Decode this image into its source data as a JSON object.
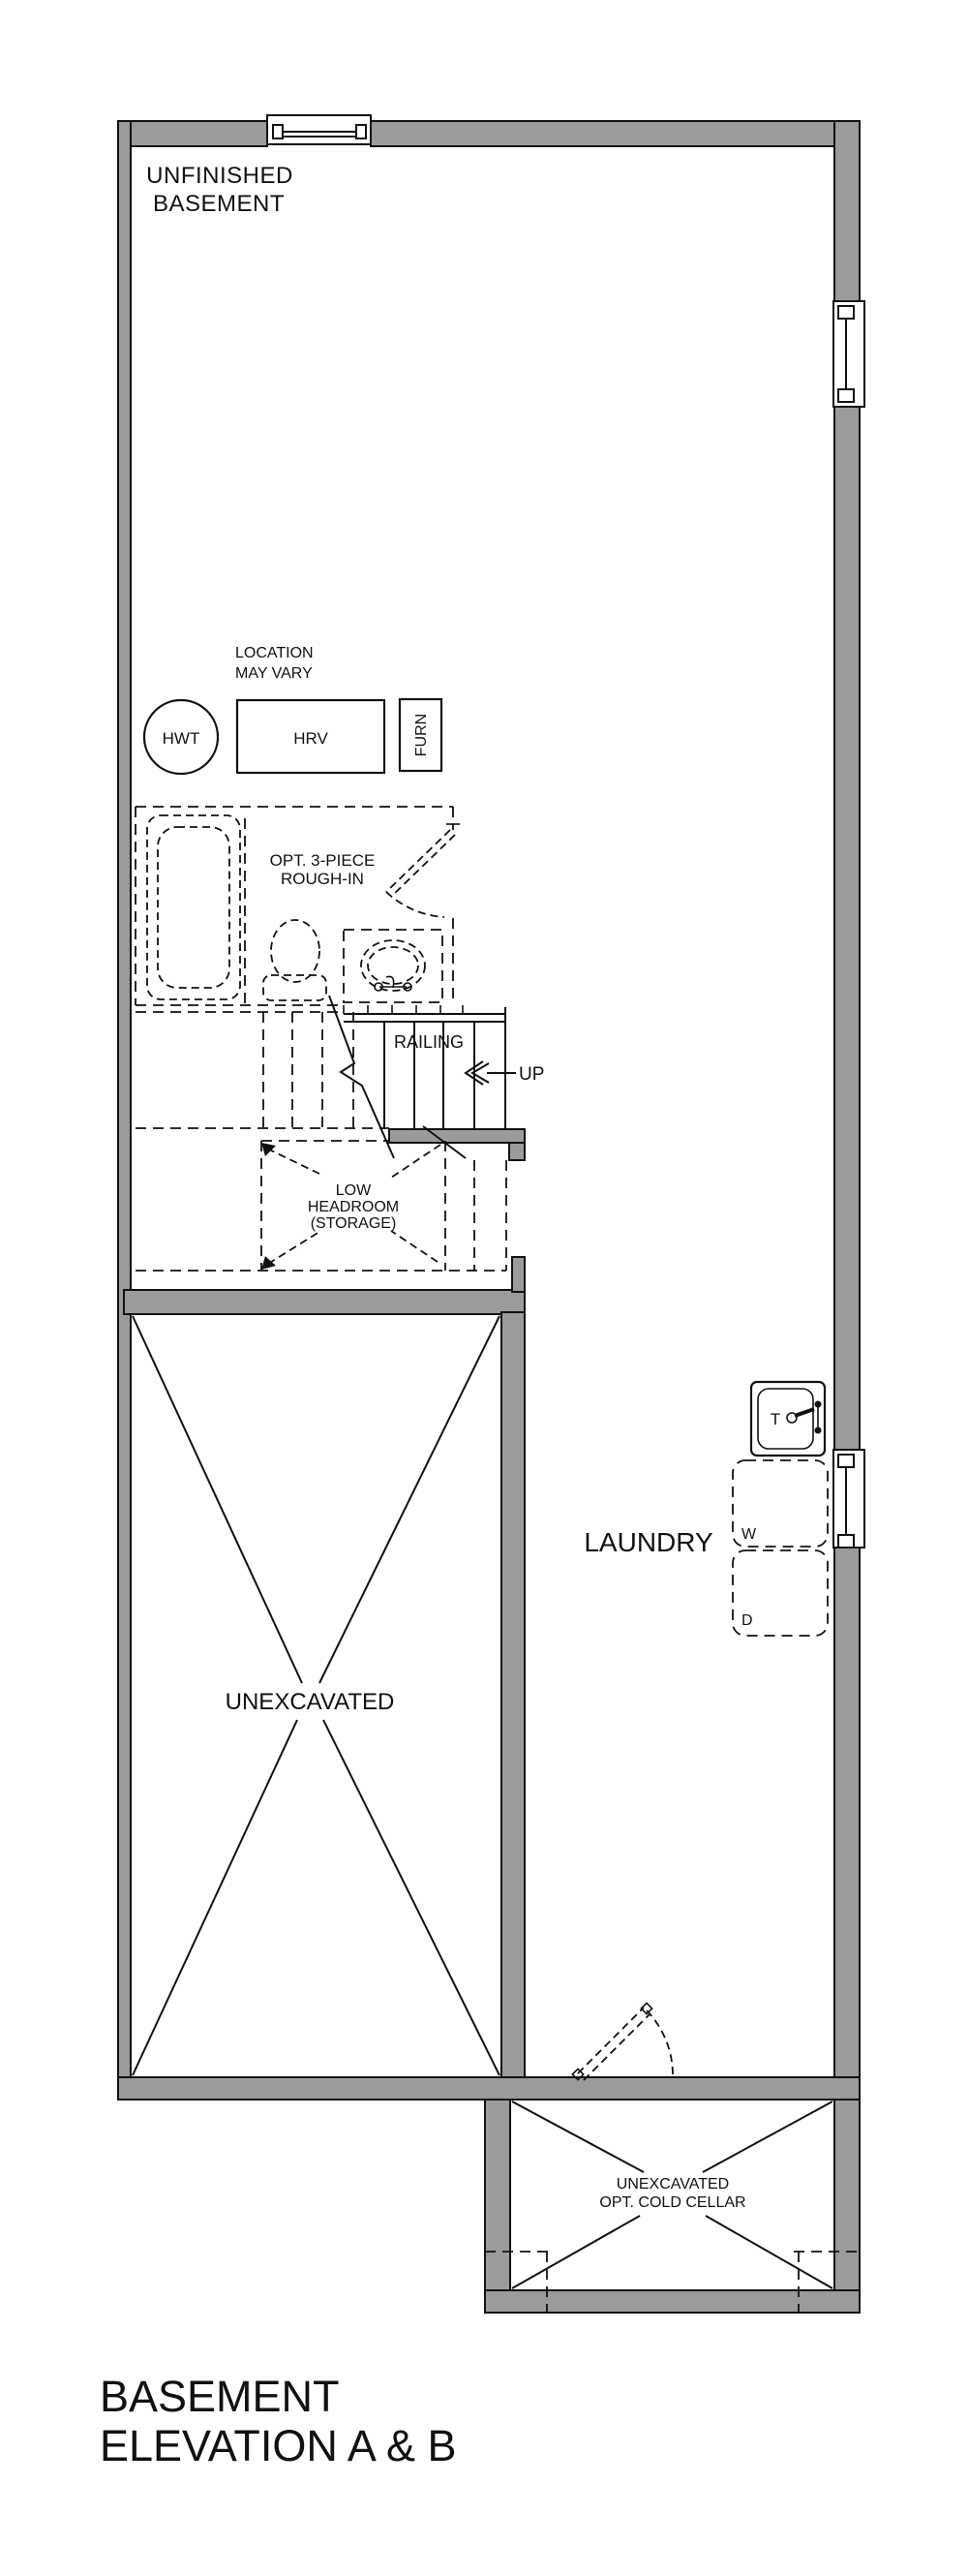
{
  "plan": {
    "room_labels": {
      "unfinished_basement_line1": "UNFINISHED",
      "unfinished_basement_line2": "BASEMENT",
      "laundry": "LAUNDRY",
      "unexcavated": "UNEXCAVATED",
      "cold_cellar_line1": "UNEXCAVATED",
      "cold_cellar_line2": "OPT. COLD CELLAR"
    },
    "annotations": {
      "location_line1": "LOCATION",
      "location_line2": "MAY VARY",
      "rough_in_line1": "OPT. 3-PIECE",
      "rough_in_line2": "ROUGH-IN",
      "low_headroom_line1": "LOW",
      "low_headroom_line2": "HEADROOM",
      "low_headroom_line3": "(STORAGE)",
      "railing": "RAILING",
      "up": "UP"
    },
    "equipment": {
      "hwt": "HWT",
      "hrv": "HRV",
      "furnace": "FURN",
      "laundry_tub": "T",
      "washer": "W",
      "dryer": "D"
    },
    "title": {
      "line1": "BASEMENT",
      "line2": "ELEVATION A & B"
    },
    "colors": {
      "wall_fill": "#9b9b9b",
      "line": "#111111",
      "background": "#ffffff"
    }
  }
}
